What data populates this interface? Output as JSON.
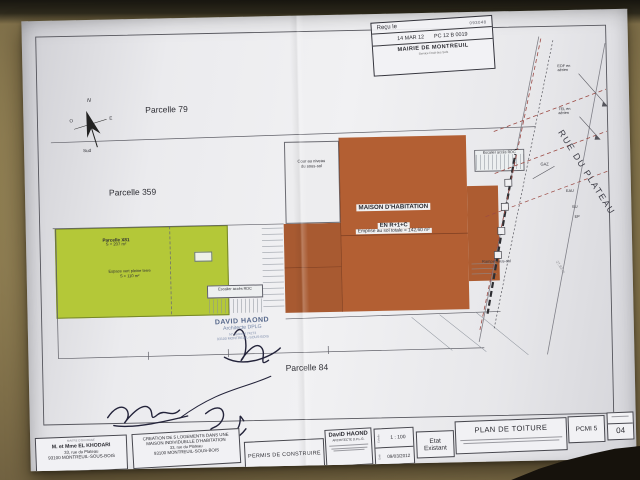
{
  "stamp_mairie": {
    "recu": "Reçu le",
    "num": "093048",
    "date": "14 MAR 12",
    "ref": "PC 12 B 0019",
    "name": "MAIRIE DE MONTREUIL",
    "service": "Service Droit des Sols"
  },
  "compass": {
    "n": "N",
    "o": "O",
    "e": "E",
    "s": "Sud"
  },
  "site": {
    "parcelle79": "Parcelle 79",
    "parcelle359": "Parcelle 359",
    "parcelle84": "Parcelle 84",
    "green_title": "Parcelle X81",
    "green_area": "S = 207 m²",
    "green_sub": "Espace vert pleine terre",
    "green_sub_area": "S = 110 m²",
    "cour_l1": "Cour au niveau",
    "cour_l2": "du sous-sol",
    "escalier": "Escalier accès RDC",
    "rampe": "Rampe sous-sol",
    "maison_l1": "MAISON D'HABITATION",
    "maison_l2": "EN R+1+C",
    "emprise": "Emprise au sol totale = 142,60 m²",
    "rue": "RUE DU PLATEAU",
    "edf_l1": "EDF en",
    "edf_l2": "aérien",
    "tel_l1": "TEL en",
    "tel_l2": "aérien",
    "gaz": "GAZ",
    "eau": "EAU",
    "eu": "EU",
    "ep": "EP",
    "dim": "27,83 m"
  },
  "stamp_architect": {
    "name": "DAVID HAOND",
    "title": "Architecte DPLG",
    "reg": "N° national 74273",
    "city": "93100 MONTREUIL-SOUS-BOIS"
  },
  "titleblock": {
    "owner_header": "MAITRE D'OUVRAGE",
    "owner_name": "M. et Mme EL KHODARI",
    "owner_addr1": "33, rue du Plateau",
    "owner_addr2": "93100 MONTREUIL-SOUS-BOIS",
    "project_l1": "CREATION DE 5 LOGEMENTS DANS UNE",
    "project_l2": "MAISON INDIVIDUELLE D'HABITATION",
    "project_addr1": "33, rue du Plateau",
    "project_addr2": "93100 MONTREUIL-SOUS-BOIS",
    "permit": "PERMIS DE CONSTRUIRE",
    "architect_name": "DaviD HAOND",
    "architect_title": "ARCHITECTE D.P.L.G.",
    "scale_label": "Echelle",
    "scale_value": "1 : 100",
    "date_label": "Date",
    "date_value": "09/03/2012",
    "state_l1": "Etat",
    "state_l2": "Existant",
    "sheet_title": "PLAN DE TOITURE",
    "code": "PCMI 5",
    "folio": "04"
  },
  "colors": {
    "paper": "#ececef",
    "desk": "#8d7c51",
    "green_parcel": "#b4c838",
    "building": "#b35f33",
    "dashed_red": "#9c4b45",
    "stamp_blue": "#55678a"
  }
}
